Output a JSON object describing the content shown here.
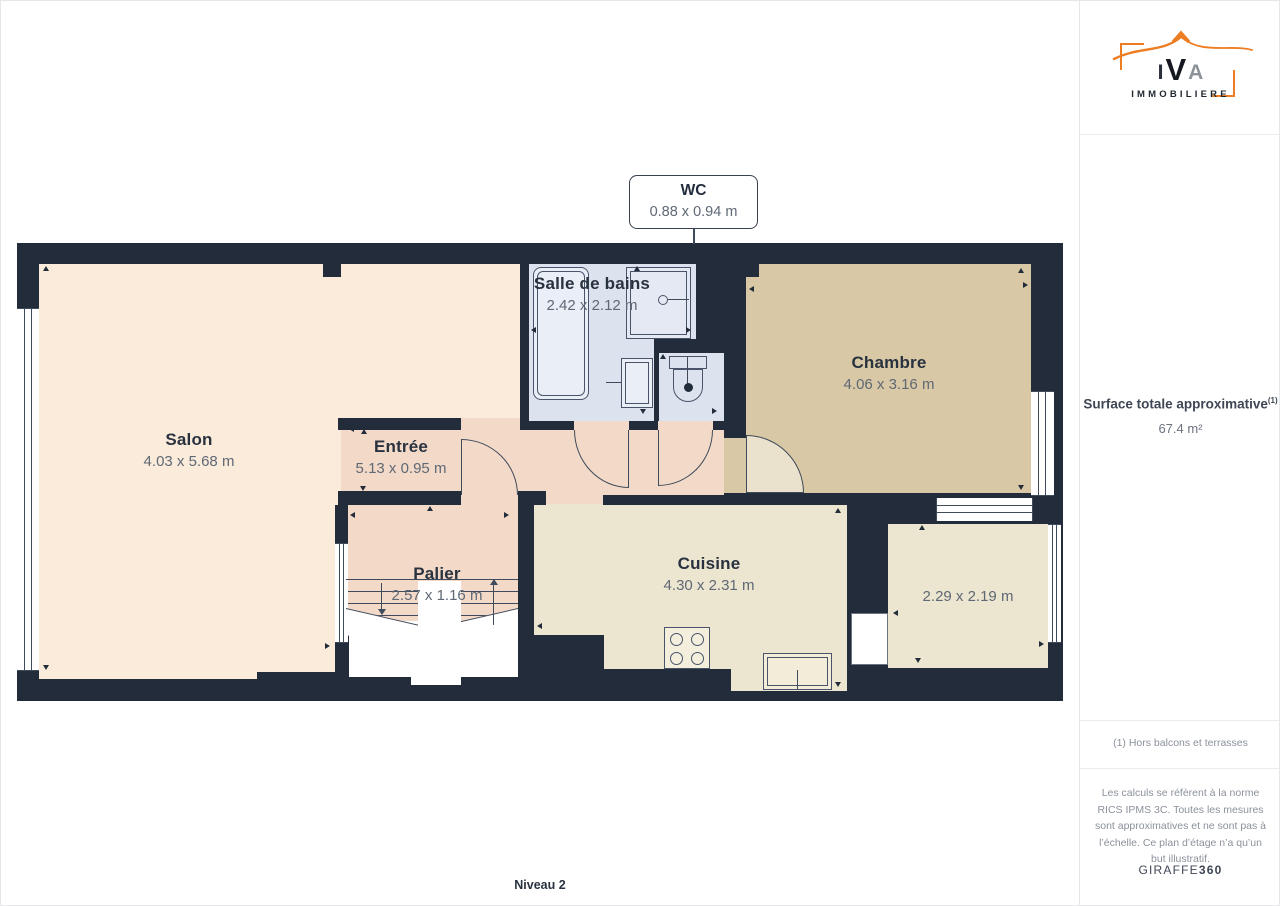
{
  "plan": {
    "level_label": "Niveau 2",
    "callout": {
      "name": "WC",
      "dims": "0.88 x 0.94 m"
    },
    "rooms": {
      "salon": {
        "name": "Salon",
        "dims": "4.03 x 5.68 m"
      },
      "entree": {
        "name": "Entrée",
        "dims": "5.13 x 0.95 m"
      },
      "salle_de_bains": {
        "name": "Salle de bains",
        "dims": "2.42 x 2.12 m"
      },
      "chambre": {
        "name": "Chambre",
        "dims": "4.06 x 3.16 m"
      },
      "palier": {
        "name": "Palier",
        "dims": "2.57 x 1.16 m"
      },
      "cuisine": {
        "name": "Cuisine",
        "dims": "4.30 x 2.31 m"
      },
      "piece_2": {
        "name": "",
        "dims": "2.29 x 2.19 m"
      }
    },
    "ticks": [
      {
        "x": 46,
        "y": 267,
        "d": "up"
      },
      {
        "x": 46,
        "y": 666,
        "d": "down"
      },
      {
        "x": 326,
        "y": 646,
        "d": "right"
      },
      {
        "x": 350,
        "y": 429,
        "d": "left"
      },
      {
        "x": 364,
        "y": 430,
        "d": "up"
      },
      {
        "x": 363,
        "y": 487,
        "d": "down"
      },
      {
        "x": 430,
        "y": 507,
        "d": "up"
      },
      {
        "x": 351,
        "y": 515,
        "d": "left"
      },
      {
        "x": 505,
        "y": 515,
        "d": "right"
      },
      {
        "x": 532,
        "y": 330,
        "d": "left"
      },
      {
        "x": 637,
        "y": 267,
        "d": "up"
      },
      {
        "x": 687,
        "y": 330,
        "d": "right"
      },
      {
        "x": 643,
        "y": 410,
        "d": "down"
      },
      {
        "x": 663,
        "y": 355,
        "d": "up"
      },
      {
        "x": 713,
        "y": 411,
        "d": "right"
      },
      {
        "x": 750,
        "y": 289,
        "d": "left"
      },
      {
        "x": 1021,
        "y": 269,
        "d": "up"
      },
      {
        "x": 1024,
        "y": 285,
        "d": "right"
      },
      {
        "x": 1021,
        "y": 486,
        "d": "down"
      },
      {
        "x": 838,
        "y": 509,
        "d": "up"
      },
      {
        "x": 538,
        "y": 626,
        "d": "left"
      },
      {
        "x": 838,
        "y": 683,
        "d": "down"
      },
      {
        "x": 922,
        "y": 526,
        "d": "up"
      },
      {
        "x": 894,
        "y": 613,
        "d": "left"
      },
      {
        "x": 1040,
        "y": 644,
        "d": "right"
      },
      {
        "x": 918,
        "y": 659,
        "d": "down"
      }
    ]
  },
  "sidebar": {
    "logo": {
      "l1": "I",
      "l2": "V",
      "l3": "A",
      "sub": "IMMOBILIERE"
    },
    "surface": {
      "label": "Surface totale approximative",
      "footnote_ref": "(1)",
      "value": "67.4 m²"
    },
    "footnote": "(1) Hors balcons et terrasses",
    "legal": "Les calculs se réfèrent à la norme RICS IPMS 3C. Toutes les mesures sont approximatives et ne sont pas à l’échelle. Ce plan d’étage n’a qu’un but illustratif.",
    "brand": {
      "name": "GIRAFFE",
      "suffix": "360"
    }
  },
  "colors": {
    "wall": "#222c3a",
    "salon_floor": "#fbebdb",
    "hallway_floor": "#f3dac8",
    "bathroom_floor": "#dde3ee",
    "bedroom_floor": "#d8c8a5",
    "kitchen_floor": "#ece5cf",
    "accent_orange": "#ed7d23",
    "label_dark": "#29323f",
    "label_dim": "#5f6875"
  }
}
